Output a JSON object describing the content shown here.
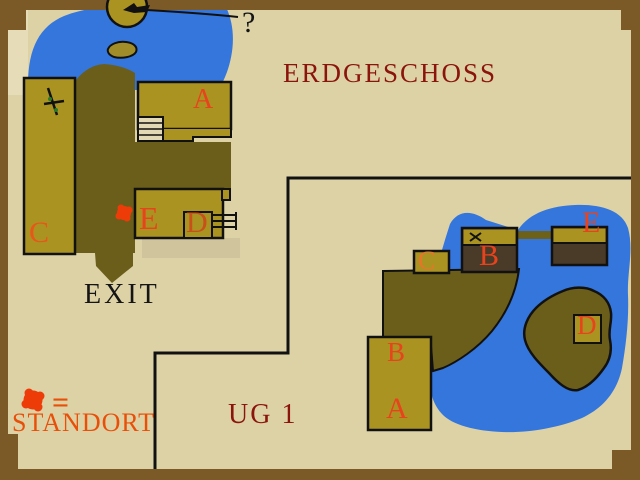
{
  "map": {
    "ground_floor": {
      "title": "ERDGESCHOSS",
      "exit_label": "EXIT",
      "unknown_marker": "?",
      "rooms": {
        "A": "A",
        "C": "C",
        "D": "D",
        "E": "E"
      }
    },
    "basement": {
      "title": "UG 1",
      "entry_label": "B",
      "rooms": {
        "A": "A",
        "B": "B",
        "C": "C",
        "D": "D",
        "E": "E"
      }
    },
    "legend": {
      "equals_sign": "=",
      "standort_label": "STANDORT"
    }
  },
  "colors": {
    "parchment": "#ddd2a6",
    "frame_brown": "#7b5a27",
    "water_blue": "#3576dc",
    "building_olive": "#ab9322",
    "ground_dark_olive": "#6b5e1b",
    "room_dark_brown": "#4a3b28",
    "title_dark_red": "#8b150c",
    "room_letter_red": "#e8431c",
    "standort_orange": "#e8500a",
    "marker_red": "#ee3c08"
  }
}
